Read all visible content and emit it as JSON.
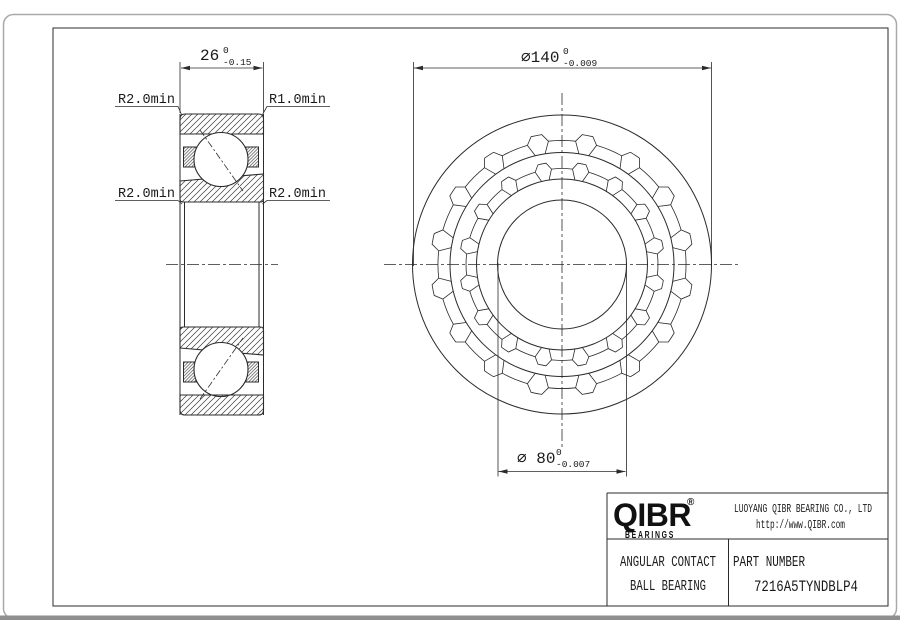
{
  "drawing": {
    "dimensions": {
      "width": {
        "value": "26",
        "tol_upper": "0",
        "tol_lower": "-0.15"
      },
      "outer_diameter": {
        "value": "⌀140",
        "tol_upper": "0",
        "tol_lower": "-0.009"
      },
      "bore_diameter": {
        "value": "⌀ 80",
        "tol_upper": "0",
        "tol_lower": "-0.007"
      }
    },
    "radius_callouts": {
      "top_left": "R2.0min",
      "top_right": "R1.0min",
      "mid_left": "R2.0min",
      "mid_right": "R2.0min"
    },
    "line_color": "#2b2b2b"
  },
  "title_block": {
    "logo": {
      "text": "QIBR",
      "registered": "®",
      "subtext": "BEARINGS"
    },
    "company": "LUOYANG QIBR BEARING CO., LTD",
    "website": "http://www.QIBR.com",
    "product_type_line1": "ANGULAR CONTACT",
    "product_type_line2": "BALL BEARING",
    "part_number_label": "PART NUMBER",
    "part_number": "7216A5TYNDBLP4"
  }
}
